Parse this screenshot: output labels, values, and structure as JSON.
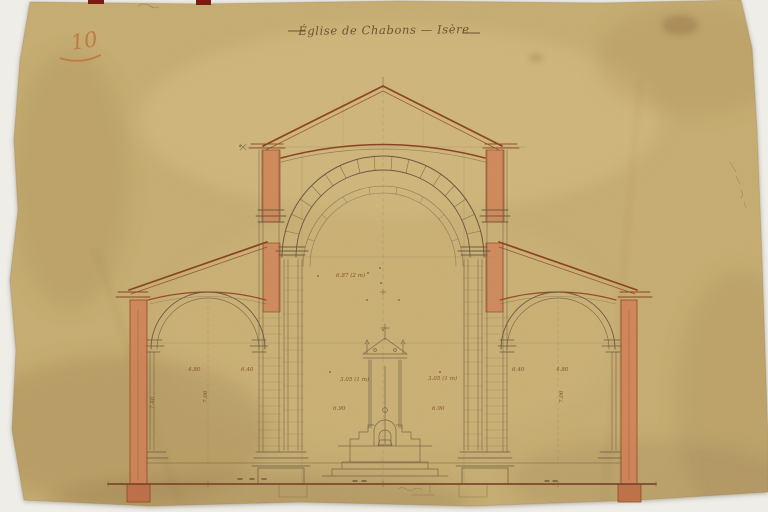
{
  "photo": {
    "background_color": "#efede7"
  },
  "paper": {
    "color": "#c7ae73"
  },
  "header": {
    "title": "Église de Chabons — Isère",
    "page_number": "10"
  },
  "colors": {
    "paper": "#c7ae73",
    "wash_orange": "#cf7f55",
    "ink_roof_brown": "#8a4423",
    "pencil_gray": "#6a5a44",
    "top_edge_mark_red": "#7c1b12",
    "crayon_orange": "#c0713f"
  },
  "drawing": {
    "annotations": [
      {
        "text": "6.87 (2 m)"
      },
      {
        "text": "3.05 (1 m)"
      },
      {
        "text": "3.05 (1 m)"
      },
      {
        "text": "6.90"
      },
      {
        "text": "6.90"
      },
      {
        "text": "4.80"
      },
      {
        "text": "6.40"
      },
      {
        "text": "7.06"
      },
      {
        "text": "7.40"
      },
      {
        "text": "4.80"
      },
      {
        "text": "6.40"
      },
      {
        "text": "7.06"
      }
    ]
  }
}
